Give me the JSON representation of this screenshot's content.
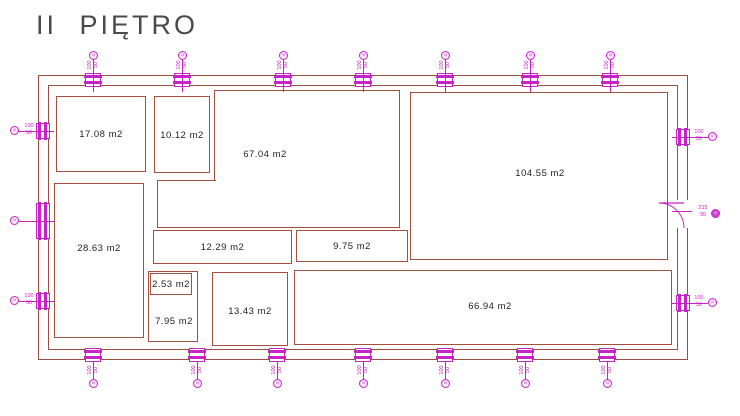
{
  "title": "II PIĘTRO",
  "colors": {
    "wall": "#9b4f42",
    "window_accent": "#c724c7",
    "room_label": "#1f1f1f",
    "title": "#4a4a4a"
  },
  "building": {
    "outer": {
      "x": 38,
      "y": 75,
      "w": 650,
      "h": 285
    },
    "inner": {
      "x": 48,
      "y": 85,
      "w": 630,
      "h": 265
    }
  },
  "rooms": [
    {
      "id": "room-17-08",
      "area": "17.08 m2",
      "x": 56,
      "y": 96,
      "w": 90,
      "h": 76
    },
    {
      "id": "room-10-12",
      "area": "10.12 m2",
      "x": 154,
      "y": 96,
      "w": 56,
      "h": 77
    },
    {
      "id": "room-67-04",
      "area": "67.04 m2",
      "x": 214,
      "y": 90,
      "w": 186,
      "h": 138,
      "notch": {
        "x": 157,
        "y": 180,
        "w": 59,
        "h": 48
      },
      "label_at": {
        "x": 265,
        "y": 154
      }
    },
    {
      "id": "room-12-29",
      "area": "12.29 m2",
      "x": 153,
      "y": 230,
      "w": 139,
      "h": 34
    },
    {
      "id": "room-9-75",
      "area": "9.75 m2",
      "x": 296,
      "y": 230,
      "w": 112,
      "h": 32
    },
    {
      "id": "room-104-55",
      "area": "104.55 m2",
      "x": 410,
      "y": 92,
      "w": 258,
      "h": 168,
      "label_at": {
        "x": 540,
        "y": 173
      }
    },
    {
      "id": "room-28-63",
      "area": "28.63 m2",
      "x": 54,
      "y": 183,
      "w": 90,
      "h": 155,
      "label_at": {
        "x": 99,
        "y": 248
      }
    },
    {
      "id": "room-7-95",
      "area": "7.95 m2",
      "x": 148,
      "y": 271,
      "w": 50,
      "h": 71,
      "label_at": {
        "x": 174,
        "y": 321
      }
    },
    {
      "id": "room-2-53",
      "area": "2.53 m2",
      "x": 150,
      "y": 273,
      "w": 42,
      "h": 22
    },
    {
      "id": "room-13-43",
      "area": "13.43 m2",
      "x": 212,
      "y": 272,
      "w": 76,
      "h": 74,
      "label_at": {
        "x": 250,
        "y": 311
      }
    },
    {
      "id": "room-66-94",
      "area": "66.94 m2",
      "x": 294,
      "y": 270,
      "w": 378,
      "h": 75,
      "label_at": {
        "x": 490,
        "y": 306
      }
    }
  ],
  "windows": {
    "top": {
      "xs": [
        93,
        182,
        283,
        363,
        445,
        530,
        610
      ],
      "label": "100/50"
    },
    "bottom": {
      "xs": [
        93,
        197,
        277,
        363,
        445,
        525,
        607
      ],
      "label": "100/50"
    },
    "left": [
      {
        "y": 131,
        "label": "100/50"
      },
      {
        "y": 221,
        "label": "",
        "tall": true
      },
      {
        "y": 301,
        "label": "100/50"
      }
    ],
    "right": [
      {
        "y": 137,
        "label": "100/50"
      },
      {
        "y": 303,
        "label": "100/50"
      }
    ]
  },
  "door": {
    "y": 214,
    "label": "215/95"
  },
  "marker_glyph": "o"
}
